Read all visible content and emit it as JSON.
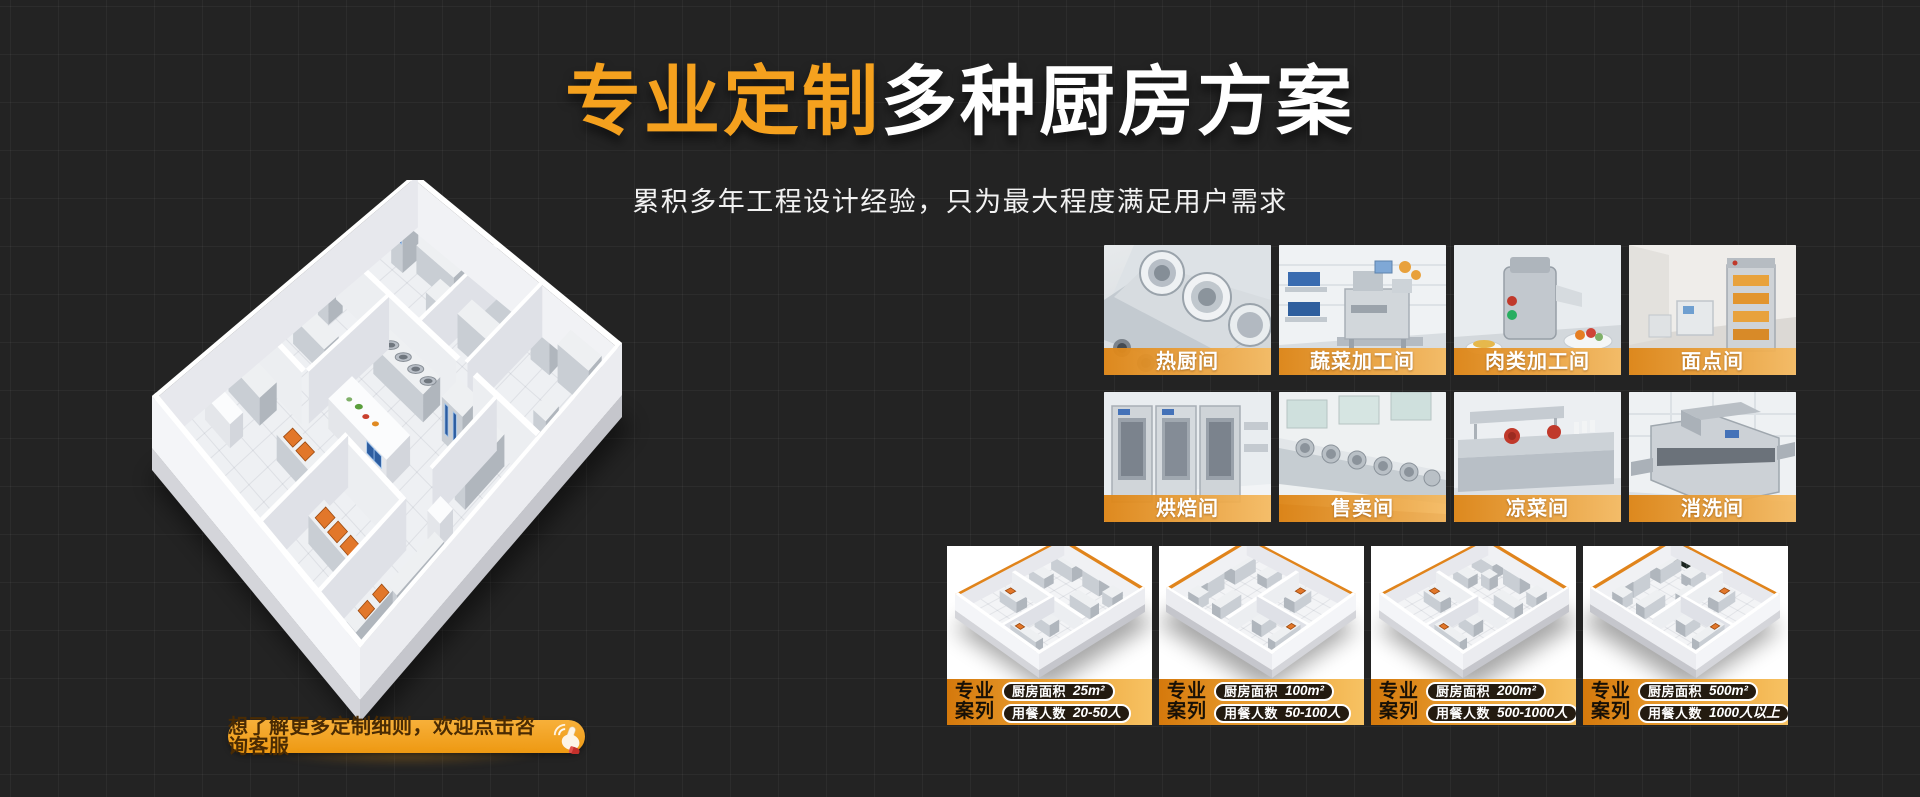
{
  "page": {
    "background_color": "#232323",
    "grid_line_color": "#2e2e2e",
    "accent_orange": "#F5A11E",
    "banner_gradient": [
      "#DD8516",
      "#F5B95E"
    ]
  },
  "hero": {
    "title_highlight": "专业定制",
    "title_rest": "多种厨房方案",
    "subtitle": "累积多年工程设计经验，只为最大程度满足用户需求"
  },
  "cta": {
    "label": "想了解更多定制细则，欢迎点击咨询客服",
    "icon": "click-hand-icon"
  },
  "room_tiles": [
    {
      "label": "热厨间"
    },
    {
      "label": "蔬菜加工间"
    },
    {
      "label": "肉类加工间"
    },
    {
      "label": "面点间"
    },
    {
      "label": "烘焙间"
    },
    {
      "label": "售卖间"
    },
    {
      "label": "凉菜间"
    },
    {
      "label": "消洗间"
    }
  ],
  "case_tag": {
    "line1": "专业",
    "line2": "案列"
  },
  "cases": [
    {
      "area_label": "厨房面积",
      "area_value": "25m²",
      "diners_label": "用餐人数",
      "diners_value": "20-50人"
    },
    {
      "area_label": "厨房面积",
      "area_value": "100m²",
      "diners_label": "用餐人数",
      "diners_value": "50-100人"
    },
    {
      "area_label": "厨房面积",
      "area_value": "200m²",
      "diners_label": "用餐人数",
      "diners_value": "500-1000人"
    },
    {
      "area_label": "厨房面积",
      "area_value": "500m²",
      "diners_label": "用餐人数",
      "diners_value": "1000人以上"
    }
  ]
}
